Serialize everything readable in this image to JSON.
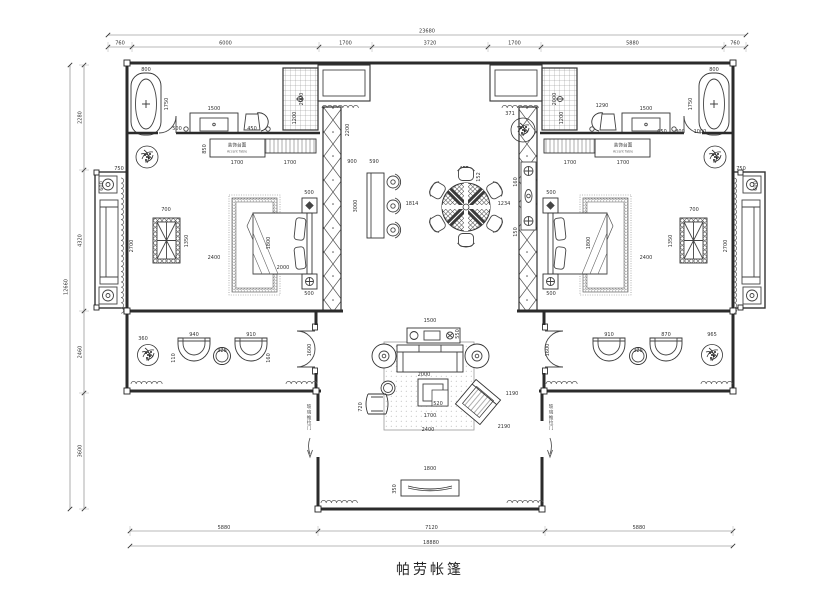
{
  "title": "帕劳帐篷",
  "labels": {
    "accent_table_cn": "装饰台面",
    "accent_table_en": "Accent Table",
    "sliding_door": "玻璃推拉门"
  },
  "dimensions": {
    "top_total": "23680",
    "top_segments": [
      "760",
      "6000",
      "1700",
      "3720",
      "1700",
      "5880",
      "760"
    ],
    "left_total": "12660",
    "left_segments": [
      "2280",
      "4320",
      "2460",
      "3600"
    ],
    "bottom_segments": [
      "5880",
      "7120",
      "5880"
    ],
    "bottom_total": "18880"
  },
  "annotations": [
    {
      "t": "800",
      "x": 146,
      "y": 71
    },
    {
      "t": "1750",
      "x": 168,
      "y": 104,
      "r": -90
    },
    {
      "t": "500",
      "x": 177,
      "y": 130
    },
    {
      "t": "1500",
      "x": 214,
      "y": 110
    },
    {
      "t": "450",
      "x": 252,
      "y": 130
    },
    {
      "t": "2000",
      "x": 303,
      "y": 99,
      "r": -90
    },
    {
      "t": "1200",
      "x": 296,
      "y": 118,
      "r": -90
    },
    {
      "t": "1700",
      "x": 237,
      "y": 164
    },
    {
      "t": "1700",
      "x": 290,
      "y": 164
    },
    {
      "t": "850",
      "x": 206,
      "y": 149,
      "r": -90
    },
    {
      "t": "900",
      "x": 352,
      "y": 163
    },
    {
      "t": "590",
      "x": 374,
      "y": 163
    },
    {
      "t": "3000",
      "x": 357,
      "y": 206,
      "r": -90
    },
    {
      "t": "2200",
      "x": 349,
      "y": 130,
      "r": -90
    },
    {
      "t": "700",
      "x": 166,
      "y": 211
    },
    {
      "t": "1350",
      "x": 188,
      "y": 241,
      "r": -90
    },
    {
      "t": "2700",
      "x": 133,
      "y": 246,
      "r": -90
    },
    {
      "t": "2400",
      "x": 214,
      "y": 259
    },
    {
      "t": "1800",
      "x": 270,
      "y": 243,
      "r": -90
    },
    {
      "t": "2000",
      "x": 283,
      "y": 269
    },
    {
      "t": "500",
      "x": 309,
      "y": 194
    },
    {
      "t": "500",
      "x": 309,
      "y": 295
    },
    {
      "t": "1814",
      "x": 412,
      "y": 205
    },
    {
      "t": "455",
      "x": 464,
      "y": 170
    },
    {
      "t": "152",
      "x": 480,
      "y": 177,
      "r": -90
    },
    {
      "t": "1234",
      "x": 504,
      "y": 205
    },
    {
      "t": "160",
      "x": 517,
      "y": 182,
      "r": -90
    },
    {
      "t": "150",
      "x": 517,
      "y": 232,
      "r": -90
    },
    {
      "t": "371",
      "x": 510,
      "y": 115
    },
    {
      "t": "360",
      "x": 143,
      "y": 340
    },
    {
      "t": "940",
      "x": 194,
      "y": 336
    },
    {
      "t": "325",
      "x": 222,
      "y": 352
    },
    {
      "t": "910",
      "x": 251,
      "y": 336
    },
    {
      "t": "110",
      "x": 175,
      "y": 358,
      "r": -90
    },
    {
      "t": "160",
      "x": 270,
      "y": 358,
      "r": -90
    },
    {
      "t": "1600",
      "x": 311,
      "y": 350,
      "r": -90
    },
    {
      "t": "1500",
      "x": 430,
      "y": 322
    },
    {
      "t": "550",
      "x": 459,
      "y": 334,
      "r": -90
    },
    {
      "t": "2000",
      "x": 424,
      "y": 376
    },
    {
      "t": "720",
      "x": 362,
      "y": 407,
      "r": -90
    },
    {
      "t": "520",
      "x": 438,
      "y": 405
    },
    {
      "t": "1700",
      "x": 430,
      "y": 417
    },
    {
      "t": "2400",
      "x": 428,
      "y": 431
    },
    {
      "t": "2190",
      "x": 504,
      "y": 428
    },
    {
      "t": "1190",
      "x": 512,
      "y": 395
    },
    {
      "t": "350",
      "x": 396,
      "y": 489,
      "r": -90
    },
    {
      "t": "1800",
      "x": 430,
      "y": 470
    },
    {
      "t": "2000",
      "x": 556,
      "y": 99,
      "r": -90
    },
    {
      "t": "1200",
      "x": 563,
      "y": 118,
      "r": -90
    },
    {
      "t": "1290",
      "x": 602,
      "y": 107
    },
    {
      "t": "1500",
      "x": 646,
      "y": 110
    },
    {
      "t": "1700",
      "x": 570,
      "y": 164
    },
    {
      "t": "1700",
      "x": 623,
      "y": 164
    },
    {
      "t": "800",
      "x": 714,
      "y": 71
    },
    {
      "t": "1750",
      "x": 692,
      "y": 104,
      "r": -90
    },
    {
      "t": "650",
      "x": 662,
      "y": 133
    },
    {
      "t": "800",
      "x": 680,
      "y": 133
    },
    {
      "t": "1000",
      "x": 700,
      "y": 133
    },
    {
      "t": "700",
      "x": 694,
      "y": 211
    },
    {
      "t": "1350",
      "x": 672,
      "y": 241,
      "r": -90
    },
    {
      "t": "2700",
      "x": 727,
      "y": 246,
      "r": -90
    },
    {
      "t": "2400",
      "x": 646,
      "y": 259
    },
    {
      "t": "1800",
      "x": 590,
      "y": 243,
      "r": -90
    },
    {
      "t": "500",
      "x": 551,
      "y": 194
    },
    {
      "t": "500",
      "x": 551,
      "y": 295
    },
    {
      "t": "965",
      "x": 712,
      "y": 336
    },
    {
      "t": "910",
      "x": 609,
      "y": 336
    },
    {
      "t": "870",
      "x": 666,
      "y": 336
    },
    {
      "t": "325",
      "x": 638,
      "y": 352
    },
    {
      "t": "1600",
      "x": 549,
      "y": 350,
      "r": -90
    },
    {
      "t": "600",
      "x": 103,
      "y": 186,
      "r": -90
    },
    {
      "t": "750",
      "x": 119,
      "y": 170
    },
    {
      "t": "600",
      "x": 757,
      "y": 186,
      "r": -90
    },
    {
      "t": "750",
      "x": 741,
      "y": 170
    }
  ]
}
